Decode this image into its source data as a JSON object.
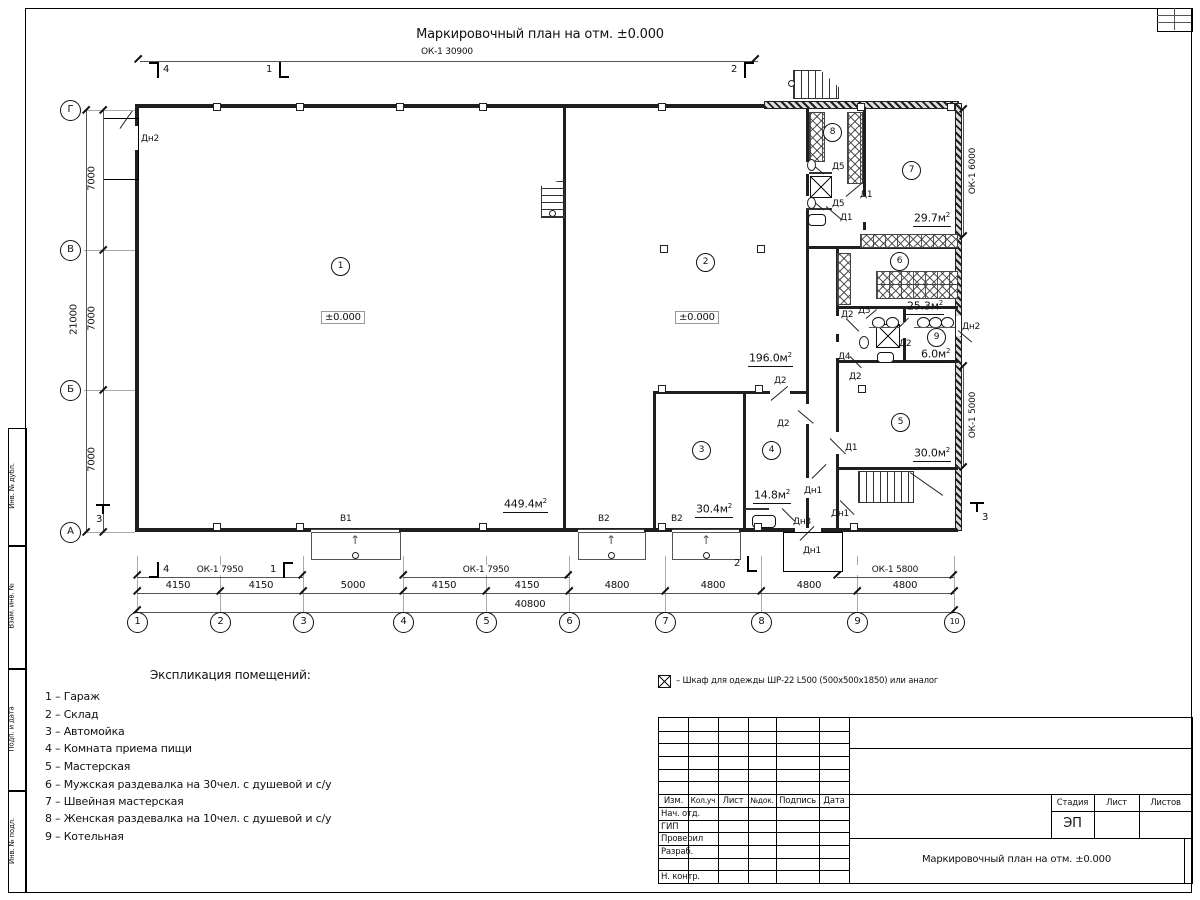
{
  "sheet": {
    "title": "Маркировочный план на отм. ±0.000",
    "top_dim_label": "ОК-1 30900"
  },
  "axes": {
    "bottom": [
      "1",
      "2",
      "3",
      "4",
      "5",
      "6",
      "7",
      "8",
      "9",
      "10"
    ],
    "left": [
      "Г",
      "В",
      "Б",
      "А"
    ]
  },
  "dims": {
    "bottom_row": [
      "4150",
      "4150",
      "5000",
      "4150",
      "4150",
      "4800",
      "4800",
      "4800",
      "4800"
    ],
    "bottom_total": "40800",
    "left_col": [
      "7000",
      "7000",
      "7000"
    ],
    "left_total": "21000",
    "right_upper": "ОК-1 6000",
    "right_lower": "ОК-1 5000",
    "win_left_a": "ОК-1 7950",
    "win_left_b": "ОК-1 7950",
    "win_right": "ОК-1 5800"
  },
  "marks": {
    "m1": "1",
    "m2": "2",
    "m3": "3",
    "m4": "4"
  },
  "plan": {
    "elevation": "±0.000",
    "numbers": [
      "1",
      "2",
      "3",
      "4",
      "5",
      "6",
      "7",
      "8",
      "9"
    ],
    "areas": {
      "a1": "449.4м",
      "a2": "196.0м",
      "a3": "30.4м",
      "a4": "14.8м",
      "a5": "30.0м",
      "a6": "25.3м",
      "a7": "29.7м",
      "a9": "6.0м"
    },
    "sup": "2",
    "doors": {
      "d1": "Д1",
      "d2": "Д2",
      "d4": "Д4",
      "d5": "Д5",
      "dn1": "Дн1",
      "dn2": "Дн2",
      "dn3": "Дн3"
    },
    "gates": {
      "v1": "В1",
      "v2": "В2"
    },
    "arrow": "↑"
  },
  "legend": {
    "title": "Экспликация помещений:",
    "items": [
      "1 – Гараж",
      "2 – Склад",
      "3 – Автомойка",
      "4 – Комната приема пищи",
      "5 – Мастерская",
      "6 – Мужская раздевалка на 30чел. с душевой и с/у",
      "7 – Швейная мастерская",
      "8 – Женская раздевалка на 10чел. с душевой и с/у",
      "9 – Котельная"
    ]
  },
  "note": {
    "text": "– Шкаф для одежды ШР-22 L500 (500x500x1850) или аналог"
  },
  "titleblock": {
    "cols": {
      "izm": "Изм.",
      "kol": "Кол.уч",
      "list": "Лист",
      "ndok": "№док.",
      "podpis": "Подпись",
      "data": "Дата"
    },
    "rows": {
      "r1": "Нач. отд.",
      "r2": "ГИП",
      "r3": "Проверил",
      "r4": "Разраб.",
      "r6": "Н. контр."
    },
    "stage_label": "Стадия",
    "sheet_label": "Лист",
    "sheets_label": "Листов",
    "stage_value": "ЭП",
    "doc_title": "Маркировочный план на отм. ±0.000"
  },
  "margin": {
    "b1": "Инв. № подл.",
    "b2": "Подп. и дата",
    "b3": "Взам. инв. №",
    "b4": "Инв. № дубл."
  }
}
